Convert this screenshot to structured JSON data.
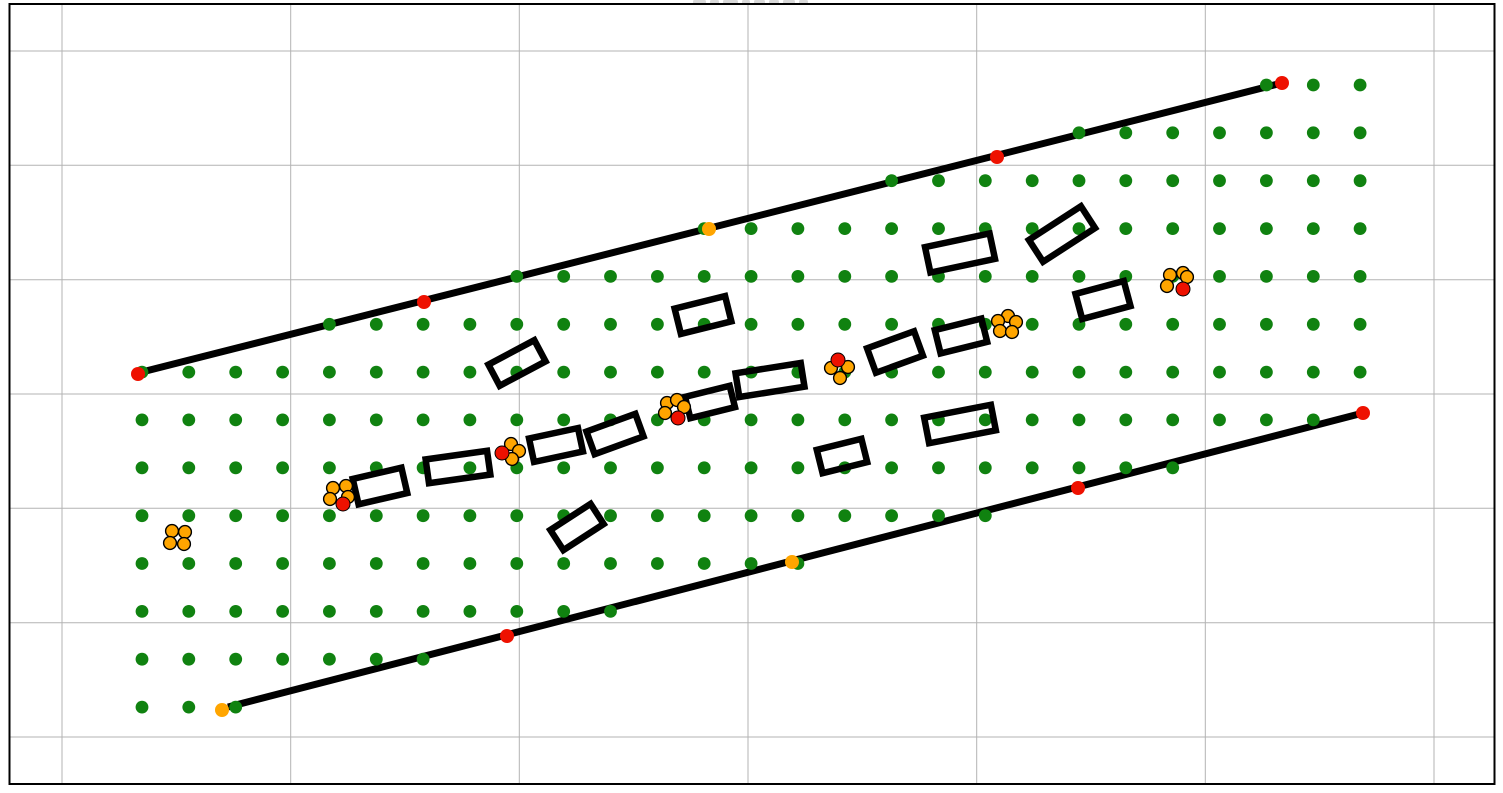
{
  "figure": {
    "width_px": 1503,
    "height_px": 793,
    "background": "#ffffff",
    "clipped_title_fragment": {
      "visible": true,
      "x_start_px": 693,
      "y_px": 0,
      "approx_width_px": 118,
      "approx_height_px": 5,
      "color": "#d9d9d9"
    }
  },
  "axes": {
    "spine_color": "#000000",
    "spine_width_px": 2,
    "grid_color": "#b3b3b3",
    "grid_width_px": 1,
    "plot_box_px": {
      "left": 9.5,
      "top": 4,
      "right": 1494.5,
      "bottom": 784
    },
    "x_gridlines_px": [
      62,
      290.7,
      519.3,
      748,
      976.7,
      1205.3,
      1434
    ],
    "y_gridlines_px": [
      51,
      165.3,
      279.7,
      394,
      508.3,
      622.7,
      737
    ],
    "tick_labels_visible": false
  },
  "chart_data": {
    "type": "scatter",
    "title": "",
    "description": "Road-corridor planning figure: two parallel black road boundary lines, an axis-aligned grid of green sample points clipped to the corridor band, rotated black rectangle obstacles along the corridor center, red/orange waypoint dots on the boundary lines, and small clusters of orange circles (some with one red circle).",
    "legend_visible": false,
    "colors": {
      "sample_point": "#108210",
      "boundary_line": "#000000",
      "obstacle_outline": "#000000",
      "waypoint_red": "#ee1100",
      "waypoint_orange": "#ffa500",
      "cluster_orange": "#ffa500",
      "cluster_red": "#ee1100",
      "cluster_edge": "#000000"
    },
    "road_boundaries": [
      {
        "name": "upper",
        "x1": 138,
        "y1": 373,
        "x2": 1282,
        "y2": 83,
        "stroke_width": 7
      },
      {
        "name": "lower",
        "x1": 228,
        "y1": 707,
        "x2": 1363,
        "y2": 413,
        "stroke_width": 7
      }
    ],
    "sample_point_grid": {
      "x0": 142,
      "dx": 46.85,
      "cols": 27,
      "y0": 85,
      "dy": 47.85,
      "rows": 14,
      "radius": 6.4,
      "clip_rule": "point kept only if it lies between the two road boundary lines (lines extended), tolerance 6 px"
    },
    "obstacles": [
      {
        "cx": 517,
        "cy": 363,
        "w": 52,
        "h": 24,
        "angle_deg": -28
      },
      {
        "cx": 380,
        "cy": 486,
        "w": 50,
        "h": 26,
        "angle_deg": -13
      },
      {
        "cx": 458,
        "cy": 467,
        "w": 62,
        "h": 24,
        "angle_deg": -8
      },
      {
        "cx": 556,
        "cy": 445,
        "w": 50,
        "h": 24,
        "angle_deg": -12
      },
      {
        "cx": 615,
        "cy": 434,
        "w": 52,
        "h": 24,
        "angle_deg": -20
      },
      {
        "cx": 710,
        "cy": 402,
        "w": 46,
        "h": 22,
        "angle_deg": -14
      },
      {
        "cx": 770,
        "cy": 380,
        "w": 66,
        "h": 24,
        "angle_deg": -9
      },
      {
        "cx": 895,
        "cy": 352,
        "w": 50,
        "h": 26,
        "angle_deg": -20
      },
      {
        "cx": 961,
        "cy": 336,
        "w": 48,
        "h": 24,
        "angle_deg": -14
      },
      {
        "cx": 960,
        "cy": 424,
        "w": 68,
        "h": 26,
        "angle_deg": -11
      },
      {
        "cx": 842,
        "cy": 456,
        "w": 46,
        "h": 24,
        "angle_deg": -14
      },
      {
        "cx": 703,
        "cy": 315,
        "w": 52,
        "h": 26,
        "angle_deg": -14
      },
      {
        "cx": 960,
        "cy": 253,
        "w": 66,
        "h": 26,
        "angle_deg": -12
      },
      {
        "cx": 1062,
        "cy": 234,
        "w": 62,
        "h": 26,
        "angle_deg": -33
      },
      {
        "cx": 1103,
        "cy": 300,
        "w": 50,
        "h": 26,
        "angle_deg": -15
      },
      {
        "cx": 577,
        "cy": 527,
        "w": 48,
        "h": 24,
        "angle_deg": -33
      }
    ],
    "obstacle_stroke_width": 6.5,
    "boundary_waypoints": {
      "radius": 7,
      "upper": [
        {
          "x": 138,
          "y": 374,
          "color": "red"
        },
        {
          "x": 424,
          "y": 302,
          "color": "red"
        },
        {
          "x": 709,
          "y": 229,
          "color": "orange"
        },
        {
          "x": 997,
          "y": 157,
          "color": "red"
        },
        {
          "x": 1282,
          "y": 83,
          "color": "red"
        }
      ],
      "lower": [
        {
          "x": 222,
          "y": 710,
          "color": "orange"
        },
        {
          "x": 507,
          "y": 636,
          "color": "red"
        },
        {
          "x": 792,
          "y": 562,
          "color": "orange"
        },
        {
          "x": 1078,
          "y": 488,
          "color": "red"
        },
        {
          "x": 1363,
          "y": 413,
          "color": "red"
        }
      ]
    },
    "clusters": {
      "orange_radius": 6.4,
      "red_radius": 7,
      "edge_width": 1.4,
      "items": [
        {
          "cx": 178,
          "cy": 538,
          "orange_offsets": [
            [
              -6,
              -7
            ],
            [
              7,
              -6
            ],
            [
              -8,
              5
            ],
            [
              6,
              6
            ]
          ],
          "red_offset": null
        },
        {
          "cx": 340,
          "cy": 495,
          "orange_offsets": [
            [
              -7,
              -7
            ],
            [
              6,
              -9
            ],
            [
              -10,
              4
            ],
            [
              8,
              2
            ]
          ],
          "red_offset": [
            3,
            9
          ]
        },
        {
          "cx": 511,
          "cy": 452,
          "orange_offsets": [
            [
              0,
              -8
            ],
            [
              8,
              -1
            ],
            [
              1,
              7
            ]
          ],
          "red_offset": [
            -9,
            1
          ]
        },
        {
          "cx": 675,
          "cy": 410,
          "orange_offsets": [
            [
              -8,
              -7
            ],
            [
              2,
              -10
            ],
            [
              9,
              -3
            ],
            [
              -10,
              3
            ]
          ],
          "red_offset": [
            3,
            8
          ]
        },
        {
          "cx": 840,
          "cy": 369,
          "orange_offsets": [
            [
              -9,
              -1
            ],
            [
              8,
              -2
            ],
            [
              0,
              9
            ]
          ],
          "red_offset": [
            -2,
            -9
          ]
        },
        {
          "cx": 1006,
          "cy": 324,
          "orange_offsets": [
            [
              2,
              -8
            ],
            [
              -8,
              -3
            ],
            [
              10,
              -2
            ],
            [
              -6,
              7
            ],
            [
              6,
              8
            ]
          ],
          "red_offset": null
        },
        {
          "cx": 1177,
          "cy": 281,
          "orange_offsets": [
            [
              -7,
              -6
            ],
            [
              6,
              -8
            ],
            [
              -10,
              5
            ],
            [
              10,
              -4
            ]
          ],
          "red_offset": [
            6,
            8
          ]
        }
      ]
    }
  }
}
